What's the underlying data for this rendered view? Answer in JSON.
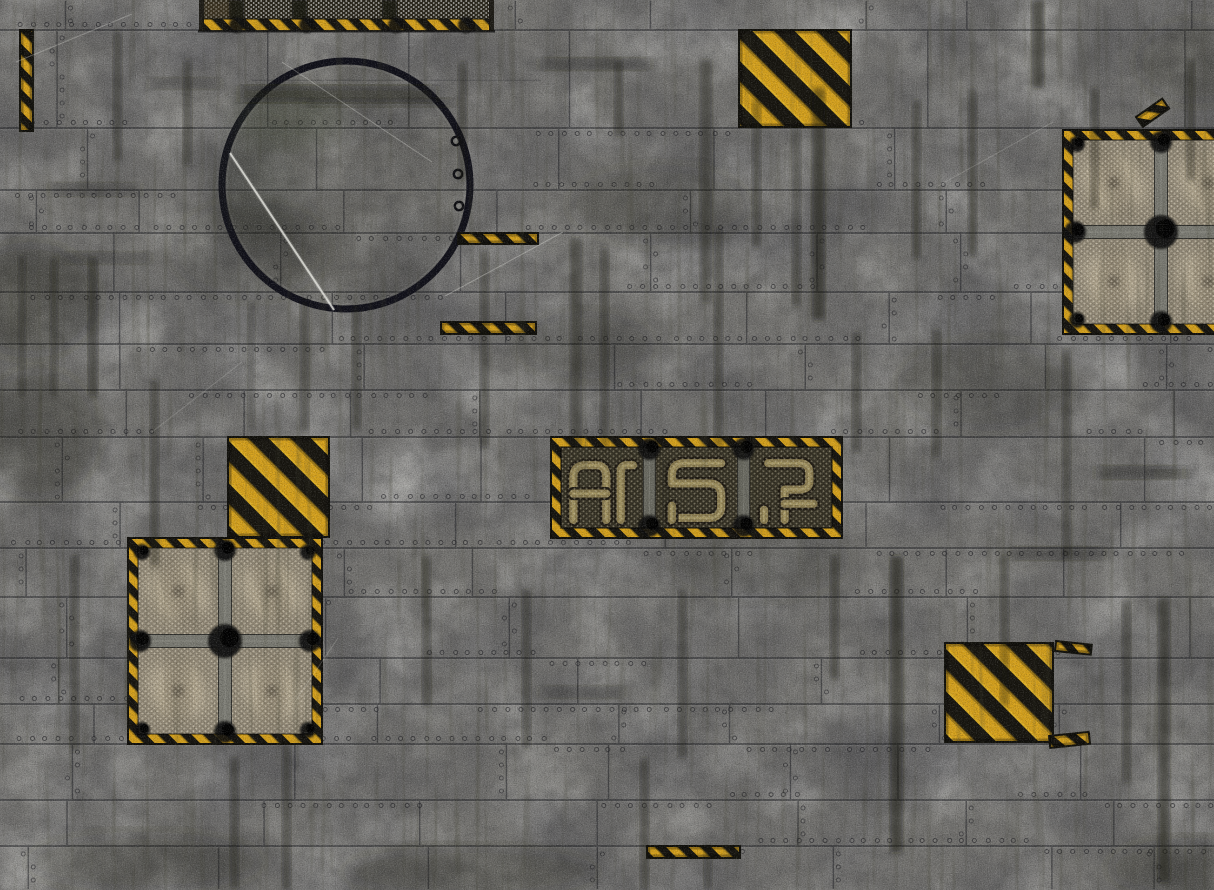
{
  "scene": {
    "title": "grimy industrial sci-fi deck-plate battle mat",
    "kind": "tabletop-wargame-floor-texture",
    "width": 1214,
    "height": 890,
    "palette": {
      "base_gray": "#787774",
      "seam_dark": "#1d1e23",
      "hazard_yellow": "#d9a41d",
      "hazard_black": "#17150f",
      "fan_mesh_tan": "#8e8573",
      "mesh_dot_light": "#ece4cd",
      "conduit_dark": "#332f22",
      "pipe_olive": "#8b7c4f",
      "beam_gray": "#7d7d75",
      "hub_black": "#0b0b09",
      "hatch_ring": "#101019",
      "scratch_white": "#eeeee8"
    },
    "grid": {
      "rows": [
        30,
        128,
        190,
        233,
        292,
        344,
        390,
        437,
        502,
        548,
        597,
        658,
        704,
        744,
        800,
        846
      ]
    },
    "features": [
      {
        "id": "top-conduit-header-panel",
        "type": "mesh-header-panel",
        "label": "perforated conduit panel with hazard edge",
        "x": 203,
        "y": 0,
        "w": 287,
        "h": 31
      },
      {
        "id": "round-hatch",
        "type": "round-hatch",
        "label": "large circular deck hatch with rivets and scratch",
        "cx": 346,
        "cy": 185,
        "r": 124
      },
      {
        "id": "hazard-square-top-right",
        "type": "hazard-square",
        "label": "yellow-black chevron warning plate",
        "x": 739,
        "y": 30,
        "w": 112,
        "h": 97
      },
      {
        "id": "fan-vent-panel-right",
        "type": "fan-vent-panel",
        "label": "meshed quad fan vent, clipped at right edge",
        "x": 1063,
        "y": 130,
        "w": 196,
        "h": 204
      },
      {
        "id": "hazard-strip-a",
        "type": "hazard-strip",
        "label": "short hazard tape strip",
        "x": 458,
        "y": 233,
        "w": 80,
        "h": 11
      },
      {
        "id": "hazard-strip-b",
        "type": "hazard-strip",
        "label": "short hazard tape strip",
        "x": 441,
        "y": 322,
        "w": 95,
        "h": 12
      },
      {
        "id": "hazard-square-mid",
        "type": "hazard-square",
        "label": "yellow-black chevron warning plate",
        "x": 228,
        "y": 437,
        "w": 101,
        "h": 100
      },
      {
        "id": "conduit-panel-mid",
        "type": "conduit-panel",
        "label": "three-bay meshed pipe conduit panel",
        "x": 551,
        "y": 437,
        "w": 291,
        "h": 101
      },
      {
        "id": "fan-vent-panel-left",
        "type": "fan-vent-panel",
        "label": "meshed quad fan vent",
        "x": 128,
        "y": 538,
        "w": 194,
        "h": 206
      },
      {
        "id": "hazard-square-right",
        "type": "hazard-square",
        "label": "yellow-black chevron warning plate",
        "x": 945,
        "y": 643,
        "w": 108,
        "h": 99
      },
      {
        "id": "hazard-fragment-a",
        "type": "hazard-fragment",
        "label": "small hazard tape fragment",
        "x": 1056,
        "y": 641,
        "w": 36,
        "h": 10,
        "rot": 6
      },
      {
        "id": "hazard-fragment-b",
        "type": "hazard-fragment",
        "label": "small hazard tape fragment",
        "x": 1049,
        "y": 736,
        "w": 40,
        "h": 12,
        "rot": -6
      },
      {
        "id": "hazard-fragment-c",
        "type": "hazard-fragment",
        "label": "small hazard tape fragment on fan border",
        "x": 1136,
        "y": 117,
        "w": 32,
        "h": 12,
        "rot": -35
      },
      {
        "id": "hazard-strip-bottom",
        "type": "hazard-strip",
        "label": "short hazard tape strip",
        "x": 647,
        "y": 846,
        "w": 93,
        "h": 12
      },
      {
        "id": "hazard-strip-left-vertical",
        "type": "hazard-strip-vertical",
        "label": "vertical hazard tape strip at left edge",
        "x": 20,
        "y": 30,
        "w": 13,
        "h": 101
      }
    ],
    "notes": "no text anywhere; riveted gray plates, vertical grime streaks, white scratches, yellow-black diagonal hazard markings"
  }
}
